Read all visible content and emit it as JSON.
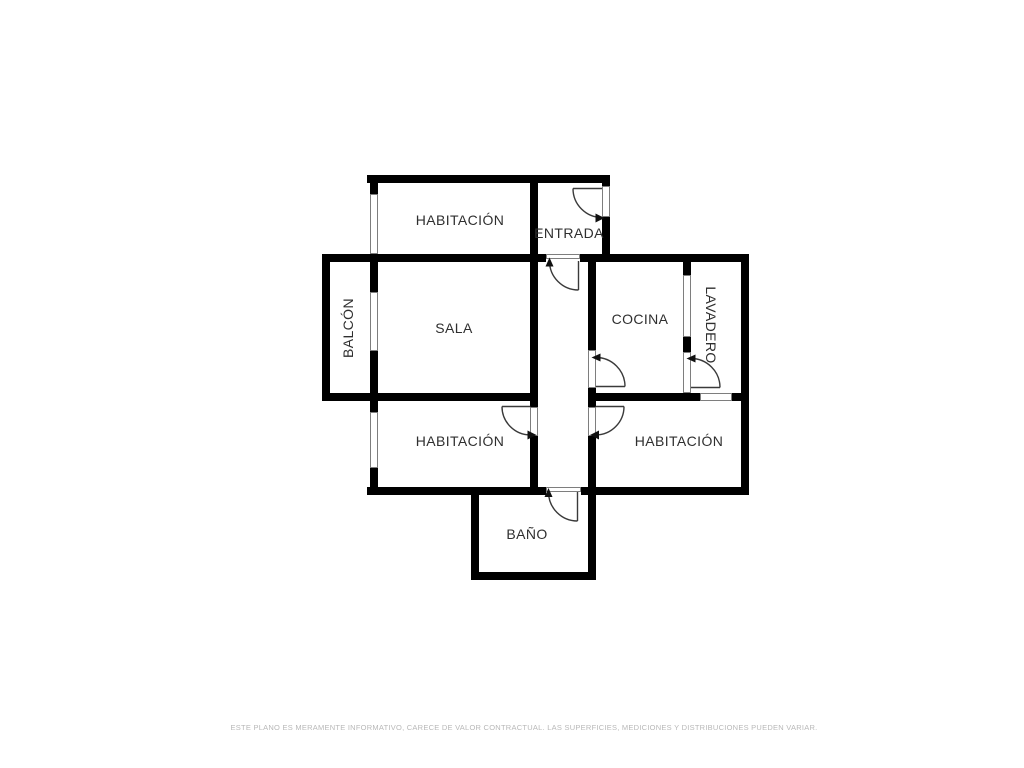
{
  "page": {
    "background": "#ffffff"
  },
  "plan": {
    "rooms": {
      "habitacion_top": {
        "label": "HABITACIÓN"
      },
      "entrada": {
        "label": "ENTRADA"
      },
      "balcon": {
        "label": "BALCÓN"
      },
      "sala": {
        "label": "SALA"
      },
      "cocina": {
        "label": "COCINA"
      },
      "lavadero": {
        "label": "LAVADERO"
      },
      "habitacion_izq": {
        "label": "HABITACIÓN"
      },
      "habitacion_der": {
        "label": "HABITACIÓN"
      },
      "bano": {
        "label": "BAÑO"
      }
    },
    "colors": {
      "wall": "#000000",
      "opening_border": "#7e7e7e",
      "door_arc": "#3a3a3a",
      "label_text": "#2f2f2f",
      "disclaimer_text": "#b8b8b8"
    }
  },
  "footer": {
    "disclaimer": "ESTE PLANO ES MERAMENTE INFORMATIVO, CARECE DE VALOR CONTRACTUAL. LAS SUPERFICIES, MEDICIONES Y DISTRIBUCIONES PUEDEN VARIAR."
  }
}
